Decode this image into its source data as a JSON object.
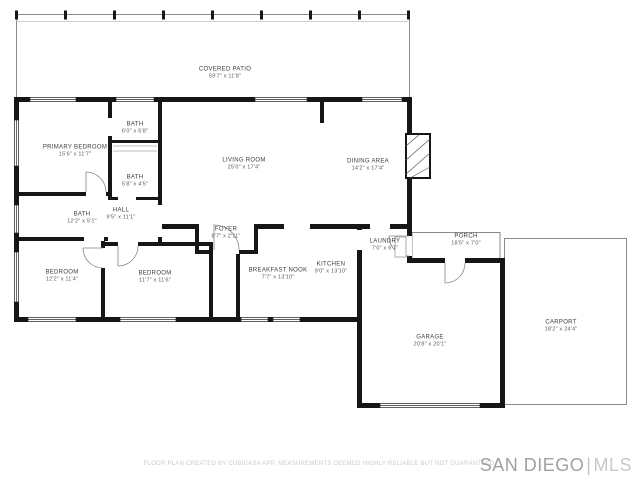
{
  "footer": {
    "disclaimer": "FLOOR PLAN CREATED BY CUBICASA APP. MEASUREMENTS DEEMED HIGHLY RELIABLE BUT NOT GUARANTEED.",
    "watermark": {
      "primary": "SAN DIEGO",
      "separator": "|",
      "secondary": "MLS"
    }
  },
  "rooms": [
    {
      "id": "covered-patio",
      "name": "COVERED PATIO",
      "dims": "59'7\" x 11'8\""
    },
    {
      "id": "primary-bedroom",
      "name": "PRIMARY BEDROOM",
      "dims": "15'6\" x 11'7\""
    },
    {
      "id": "bath-upper",
      "name": "BATH",
      "dims": "6'0\" x 5'8\""
    },
    {
      "id": "bath-middle",
      "name": "BATH",
      "dims": "5'8\" x 4'5\""
    },
    {
      "id": "living-room",
      "name": "LIVING ROOM",
      "dims": "25'0\" x 17'4\""
    },
    {
      "id": "dining-area",
      "name": "DINING AREA",
      "dims": "14'2\" x 17'4\""
    },
    {
      "id": "bath-left",
      "name": "BATH",
      "dims": "12'2\" x 5'1\""
    },
    {
      "id": "hall",
      "name": "HALL",
      "dims": "9'5\" x 11'1\""
    },
    {
      "id": "foyer",
      "name": "FOYER",
      "dims": "8'7\" x 2'11\""
    },
    {
      "id": "bedroom-left",
      "name": "BEDROOM",
      "dims": "12'2\" x 11'4\""
    },
    {
      "id": "bedroom-middle",
      "name": "BEDROOM",
      "dims": "11'7\" x 11'6\""
    },
    {
      "id": "breakfast-nook",
      "name": "BREAKFAST NOOK",
      "dims": "7'7\" x 13'10\""
    },
    {
      "id": "kitchen",
      "name": "KITCHEN",
      "dims": "9'0\" x 13'10\""
    },
    {
      "id": "laundry",
      "name": "LAUNDRY",
      "dims": "7'0\" x 6'7\""
    },
    {
      "id": "porch",
      "name": "PORCH",
      "dims": "18'5\" x 7'0\""
    },
    {
      "id": "garage",
      "name": "GARAGE",
      "dims": "20'8\" x 20'1\""
    },
    {
      "id": "carport",
      "name": "CARPORT",
      "dims": "18'2\" x 24'4\""
    }
  ],
  "colors": {
    "wall": "#161616",
    "thin_outline": "#8a8a8a",
    "label_text": "#3d3d3d",
    "disclaimer_text": "#cbcbcb",
    "watermark_primary": "#a0a0a0",
    "watermark_secondary": "#c9c9c9"
  }
}
